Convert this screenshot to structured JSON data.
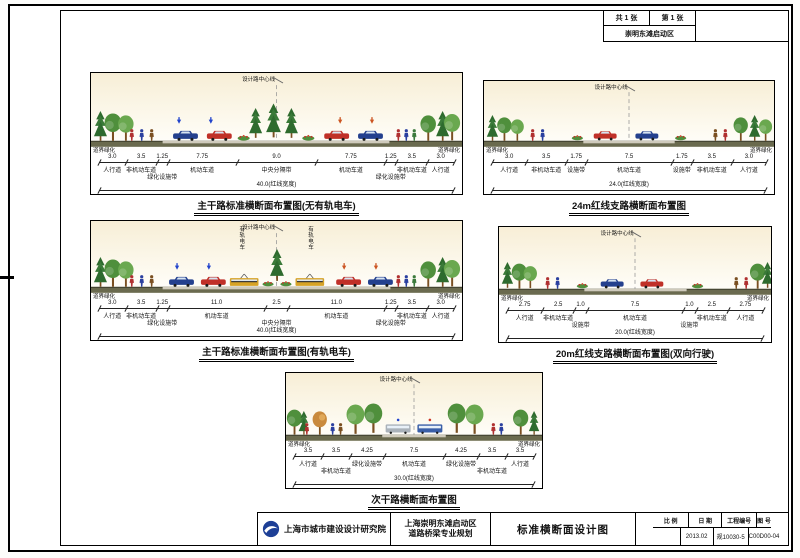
{
  "corner": {
    "total_sheets": "共 1 张",
    "sheet_no": "第 1 张",
    "area": "崇明东滩启动区"
  },
  "sections": [
    {
      "id": "main-road-no-tram",
      "title": "主干路标准横断面布置图(无有轨电车)",
      "centerline_label": "设计路中心线",
      "edge_label": "道界绿化",
      "segments": [
        {
          "w": "3.0",
          "label": "人行道"
        },
        {
          "w": "3.5",
          "label": "非机动车道"
        },
        {
          "w": "1.25",
          "label": "绿化设施带"
        },
        {
          "w": "7.75",
          "label": "机动车道"
        },
        {
          "w": "9.0",
          "label": "中央分隔带"
        },
        {
          "w": "7.75",
          "label": "机动车道"
        },
        {
          "w": "1.25",
          "label": "绿化设施带"
        },
        {
          "w": "3.5",
          "label": "非机动车道"
        },
        {
          "w": "3.0",
          "label": "人行道"
        }
      ],
      "total": "40.0(红线宽度)"
    },
    {
      "id": "branch-24m",
      "title": "24m红线支路横断面布置图",
      "centerline_label": "设计路中心线",
      "edge_label": "道界绿化",
      "segments": [
        {
          "w": "3.0",
          "label": "人行道"
        },
        {
          "w": "3.5",
          "label": "非机动车道"
        },
        {
          "w": "1.75",
          "label": "设施带"
        },
        {
          "w": "7.5",
          "label": "机动车道"
        },
        {
          "w": "1.75",
          "label": "设施带"
        },
        {
          "w": "3.5",
          "label": "非机动车道"
        },
        {
          "w": "3.0",
          "label": "人行道"
        }
      ],
      "total": "24.0(红线宽度)"
    },
    {
      "id": "main-road-with-tram",
      "title": "主干路标准横断面布置图(有轨电车)",
      "centerline_label": "设计路中心线",
      "edge_label": "道界绿化",
      "tram_label": "有轨电车",
      "segments": [
        {
          "w": "3.0",
          "label": "人行道"
        },
        {
          "w": "3.5",
          "label": "非机动车道"
        },
        {
          "w": "1.25",
          "label": "绿化设施带"
        },
        {
          "w": "11.0",
          "label": "机动车道"
        },
        {
          "w": "2.5",
          "label": "中央分隔带"
        },
        {
          "w": "11.0",
          "label": "机动车道"
        },
        {
          "w": "1.25",
          "label": "绿化设施带"
        },
        {
          "w": "3.5",
          "label": "非机动车道"
        },
        {
          "w": "3.0",
          "label": "人行道"
        }
      ],
      "total": "40.0(红线宽度)"
    },
    {
      "id": "branch-20m",
      "title": "20m红线支路横断面布置图(双向行驶)",
      "centerline_label": "设计路中心线",
      "edge_label": "道界绿化",
      "segments": [
        {
          "w": "2.75",
          "label": "人行道"
        },
        {
          "w": "2.5",
          "label": "非机动车道"
        },
        {
          "w": "1.0",
          "label": "设施带"
        },
        {
          "w": "7.5",
          "label": "机动车道"
        },
        {
          "w": "1.0",
          "label": "设施带"
        },
        {
          "w": "2.5",
          "label": "非机动车道"
        },
        {
          "w": "2.75",
          "label": "人行道"
        }
      ],
      "total": "20.0(红线宽度)"
    },
    {
      "id": "secondary-road",
      "title": "次干路横断面布置图",
      "subtitle": "S1、S2和S3",
      "centerline_label": "设计路中心线",
      "edge_label": "道界绿化",
      "segments": [
        {
          "w": "3.5",
          "label": "人行道"
        },
        {
          "w": "3.5",
          "label": "非机动车道"
        },
        {
          "w": "4.25",
          "label": "绿化设施带"
        },
        {
          "w": "7.5",
          "label": "机动车道"
        },
        {
          "w": "4.25",
          "label": "绿化设施带"
        },
        {
          "w": "3.5",
          "label": "非机动车道"
        },
        {
          "w": "3.5",
          "label": "人行道"
        }
      ],
      "total": "30.0(红线宽度)"
    }
  ],
  "title_block": {
    "company": "上海市城市建设设计研究院",
    "project_line1": "上海崇明东滩启动区",
    "project_line2": "道路桥梁专业规划",
    "drawing_title": "标准横断面设计图",
    "scale_label": "比 例",
    "date_label": "日 期",
    "project_no_label": "工程编号",
    "drawing_no_label": "图 号",
    "scale_value": "",
    "date_value": "2013.02",
    "project_no_value": "规10030-5",
    "drawing_no_value": "C00D00-04"
  },
  "colors": {
    "car_blue": "#24408e",
    "car_red": "#c03028",
    "tram_yellow": "#d7a326",
    "bus_blue": "#3a5fa8",
    "tree_green": "#4f8f3c",
    "conifer_green": "#2e6b2e",
    "ground_olive": "#6a6a4e",
    "logo_blue": "#1d3f96"
  }
}
